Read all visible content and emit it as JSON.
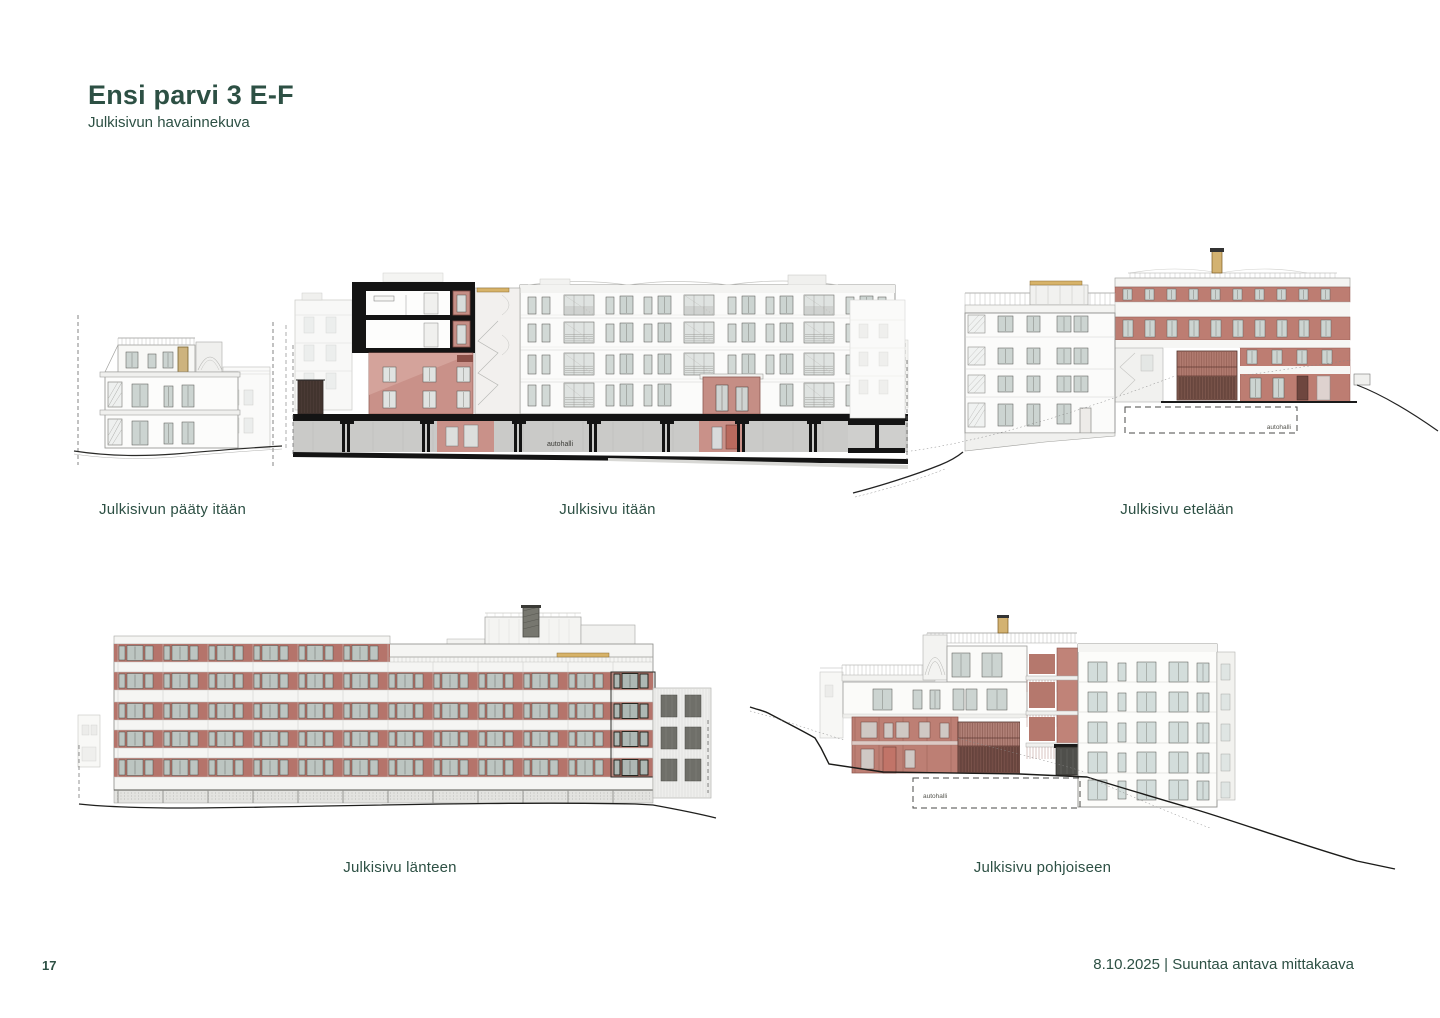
{
  "page": {
    "title": "Ensi parvi 3 E-F",
    "subtitle": "Julkisivun havainnekuva",
    "page_number": "17",
    "footer_right": "8.10.2025 | Suuntaa antava mittakaava"
  },
  "colors": {
    "accent_green": "#2d5044",
    "brick_red": "#b5746b",
    "facade_pink": "#c99189",
    "section_black": "#141414",
    "garage_gray": "#cacac8",
    "wood_tan": "#d7b369"
  },
  "elevations": {
    "east_end": {
      "caption": "Julkisivun pääty itään"
    },
    "east": {
      "caption": "Julkisivu itään",
      "garage_label": "autohalli"
    },
    "south": {
      "caption": "Julkisivu etelään",
      "garage_label": "autohalli"
    },
    "west": {
      "caption": "Julkisivu länteen"
    },
    "north": {
      "caption": "Julkisivu pohjoiseen",
      "garage_label": "autohalli"
    }
  }
}
